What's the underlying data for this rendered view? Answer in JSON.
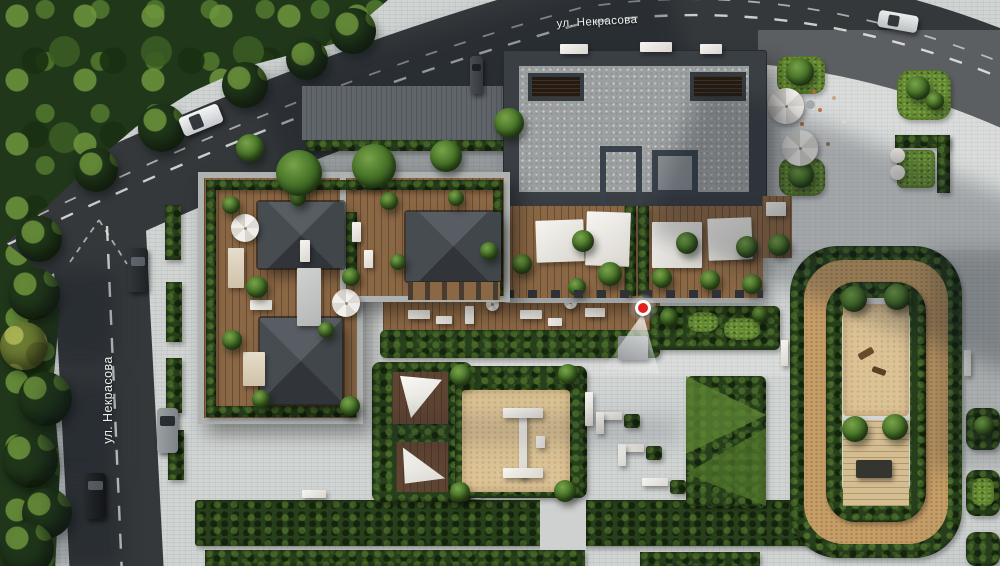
{
  "streets": {
    "top": {
      "label": "ул. Некрасова"
    },
    "left": {
      "label": "ул. Некрасова"
    }
  },
  "marker": {
    "kind": "viewpoint-pin",
    "color": "#e0211d"
  },
  "palette": {
    "asphalt": "#34383b",
    "paving": "#ccd0cf",
    "foliage": "#20371a",
    "hedge": "#273f1b",
    "grass": "#648c2f",
    "wood": "#8a6745",
    "deck_light": "#d5bd92",
    "sand": "#dcc396",
    "track": "#c49d67",
    "roof_frame": "#3a3f44",
    "concrete": "#9da0a1",
    "canopy_white": "#efede8",
    "marker_red": "#e0211d"
  }
}
